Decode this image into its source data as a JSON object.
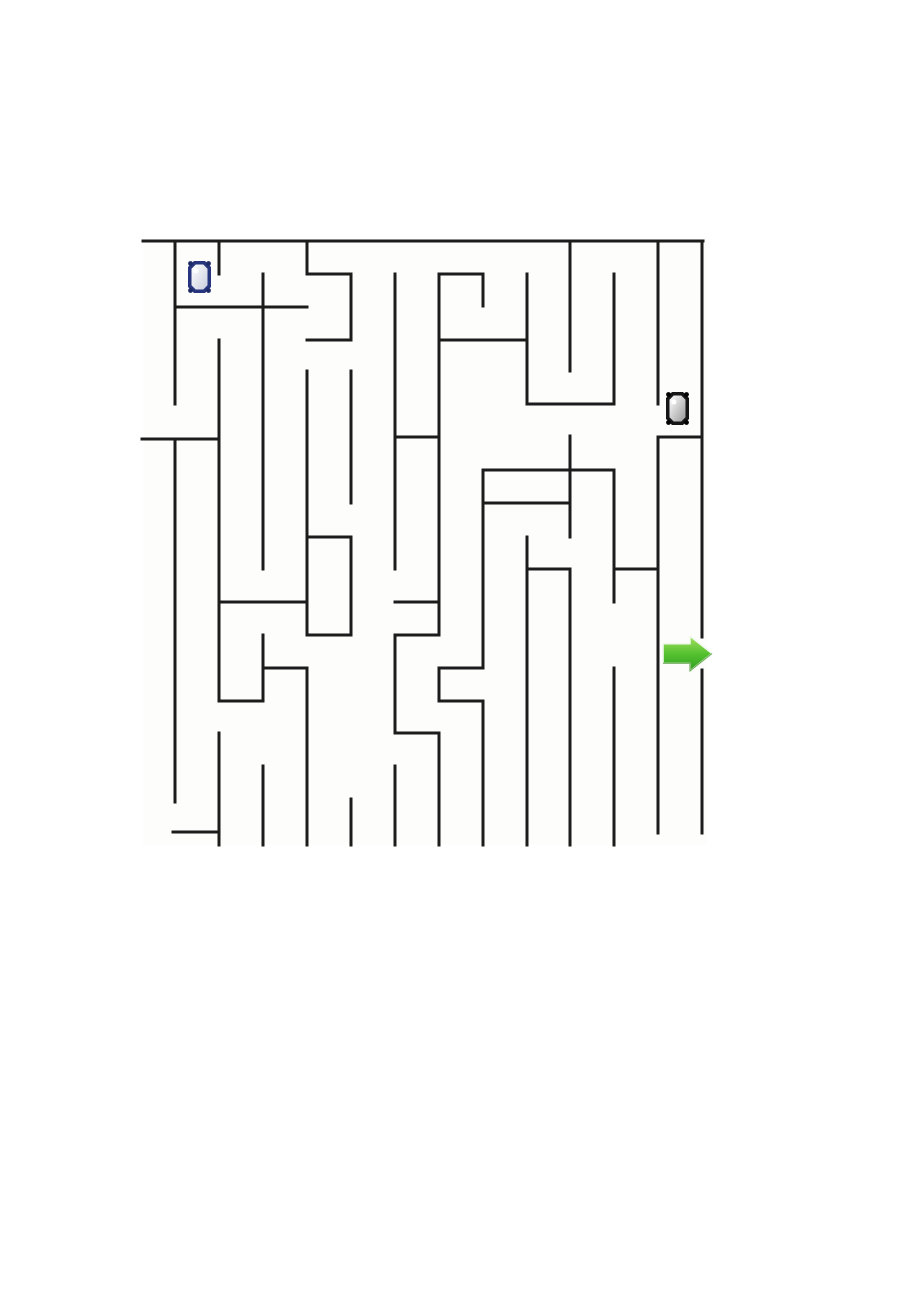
{
  "page": {
    "background": "#ffffff",
    "title": "maze-worksheet"
  },
  "maze": {
    "region": {
      "left": 143,
      "top": 238,
      "width": 564,
      "height": 607
    },
    "paper_color": "#fdfdfc",
    "wall_color": "#1c1c1c",
    "wall_thickness": 3,
    "walls": {
      "horizontal": [
        [
          143,
          241,
          703,
          241
        ],
        [
          307,
          274,
          351,
          274
        ],
        [
          439,
          274,
          483,
          274
        ],
        [
          175,
          307,
          307,
          307
        ],
        [
          307,
          340,
          351,
          340
        ],
        [
          439,
          340,
          527,
          340
        ],
        [
          527,
          404,
          614,
          404
        ],
        [
          142,
          439,
          217,
          439
        ],
        [
          395,
          437,
          439,
          437
        ],
        [
          658,
          437,
          702,
          437
        ],
        [
          483,
          470,
          614,
          470
        ],
        [
          483,
          503,
          570,
          503
        ],
        [
          307,
          537,
          351,
          537
        ],
        [
          527,
          569,
          570,
          569
        ],
        [
          614,
          569,
          658,
          569
        ],
        [
          219,
          602,
          307,
          602
        ],
        [
          395,
          602,
          439,
          602
        ],
        [
          307,
          635,
          351,
          635
        ],
        [
          395,
          635,
          439,
          635
        ],
        [
          263,
          668,
          307,
          668
        ],
        [
          439,
          668,
          483,
          668
        ],
        [
          219,
          701,
          263,
          701
        ],
        [
          439,
          701,
          483,
          701
        ],
        [
          395,
          733,
          439,
          733
        ],
        [
          173,
          832,
          219,
          832
        ]
      ],
      "vertical": [
        [
          175,
          241,
          175,
          404
        ],
        [
          175,
          439,
          175,
          802
        ],
        [
          219,
          241,
          219,
          274
        ],
        [
          219,
          340,
          219,
          701
        ],
        [
          219,
          733,
          219,
          845
        ],
        [
          263,
          274,
          263,
          569
        ],
        [
          263,
          635,
          263,
          701
        ],
        [
          263,
          766,
          263,
          845
        ],
        [
          307,
          241,
          307,
          274
        ],
        [
          307,
          371,
          307,
          635
        ],
        [
          307,
          668,
          307,
          845
        ],
        [
          351,
          274,
          351,
          340
        ],
        [
          351,
          371,
          351,
          503
        ],
        [
          351,
          537,
          351,
          635
        ],
        [
          351,
          799,
          351,
          845
        ],
        [
          395,
          274,
          395,
          569
        ],
        [
          395,
          635,
          395,
          733
        ],
        [
          395,
          766,
          395,
          845
        ],
        [
          439,
          274,
          439,
          635
        ],
        [
          439,
          668,
          439,
          701
        ],
        [
          439,
          733,
          439,
          845
        ],
        [
          483,
          274,
          483,
          306
        ],
        [
          483,
          470,
          483,
          668
        ],
        [
          483,
          701,
          483,
          845
        ],
        [
          527,
          274,
          527,
          404
        ],
        [
          527,
          537,
          527,
          845
        ],
        [
          570,
          241,
          570,
          371
        ],
        [
          570,
          436,
          570,
          537
        ],
        [
          570,
          569,
          570,
          845
        ],
        [
          614,
          274,
          614,
          404
        ],
        [
          614,
          470,
          614,
          602
        ],
        [
          614,
          668,
          614,
          845
        ],
        [
          658,
          241,
          658,
          404
        ],
        [
          658,
          437,
          658,
          833
        ],
        [
          702,
          241,
          702,
          637
        ],
        [
          702,
          670,
          702,
          833
        ]
      ]
    },
    "exit_gap": {
      "x": 702,
      "y1": 637,
      "y2": 670
    }
  },
  "items": {
    "blue_gem": {
      "icon": "blue-gem-icon",
      "x": 188,
      "y": 261,
      "width": 23,
      "height": 32,
      "outline_color": "#26357e",
      "corner_color": "#1d2a66",
      "fill_color": "#fbfbfb",
      "shade_color": "#c9cedd"
    },
    "black_gem": {
      "icon": "black-gem-icon",
      "x": 666,
      "y": 392,
      "width": 23,
      "height": 33,
      "outline_color": "#161616",
      "corner_color": "#000000",
      "fill_color": "#efefef",
      "shade_color": "#9a9a9a"
    },
    "green_arrow": {
      "icon": "green-arrow-icon",
      "x": 663,
      "y": 636,
      "width": 49,
      "height": 35,
      "color_top": "#a8e063",
      "color_mid": "#56c230",
      "color_bottom": "#2f9e22",
      "edge_color": "#3e8f22",
      "outline_color": "#f2faef"
    }
  }
}
